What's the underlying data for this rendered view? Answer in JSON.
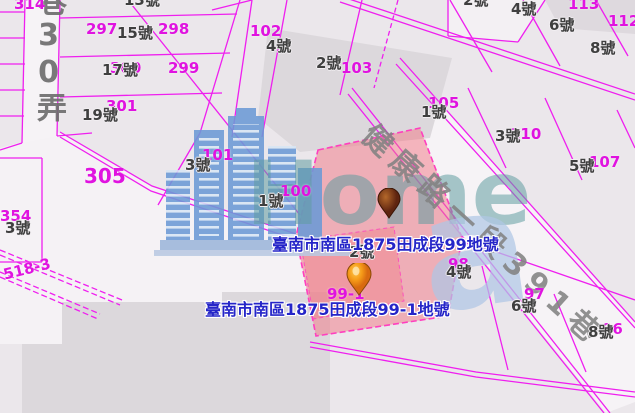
{
  "map": {
    "street_names": {
      "diagonal": "健康路一段391巷",
      "vertical": "巷30弄"
    },
    "address_labels": [
      {
        "id": "addr-99",
        "text": "臺南市南區1875田成段99地號"
      },
      {
        "id": "addr-99-1",
        "text": "臺南市南區1875田成段99-1地號"
      }
    ],
    "watermark": {
      "brand": "Home",
      "glyph": "a"
    },
    "markers": [
      {
        "id": "marker-99",
        "color": "#6b2c10"
      },
      {
        "id": "marker-99-1",
        "color": "#f59a18"
      }
    ],
    "parcel_numbers": [
      {
        "t": "314",
        "x": 14,
        "y": -3
      },
      {
        "t": "297",
        "x": 86,
        "y": 22
      },
      {
        "t": "298",
        "x": 158,
        "y": 22
      },
      {
        "t": "300",
        "x": 110,
        "y": 61
      },
      {
        "t": "299",
        "x": 168,
        "y": 61
      },
      {
        "t": "301",
        "x": 106,
        "y": 99
      },
      {
        "t": "305",
        "x": 84,
        "y": 166,
        "fs": 20
      },
      {
        "t": "102",
        "x": 250,
        "y": 24
      },
      {
        "t": "103",
        "x": 341,
        "y": 61
      },
      {
        "t": "113",
        "x": 568,
        "y": -3
      },
      {
        "t": "112",
        "x": 608,
        "y": 14
      },
      {
        "t": "105",
        "x": 428,
        "y": 96
      },
      {
        "t": "110",
        "x": 510,
        "y": 127
      },
      {
        "t": "107",
        "x": 589,
        "y": 155
      },
      {
        "t": "101",
        "x": 202,
        "y": 148
      },
      {
        "t": "100",
        "x": 280,
        "y": 184
      },
      {
        "t": "99-1",
        "x": 327,
        "y": 287
      },
      {
        "t": "98",
        "x": 448,
        "y": 257
      },
      {
        "t": "97",
        "x": 524,
        "y": 287
      },
      {
        "t": "96",
        "x": 602,
        "y": 322
      },
      {
        "t": "354",
        "x": 0,
        "y": 209
      },
      {
        "t": "518-3",
        "x": 2,
        "y": 268,
        "rot": -14
      }
    ],
    "house_numbers": [
      {
        "t": "13號",
        "x": 124,
        "y": -7
      },
      {
        "t": "15號",
        "x": 117,
        "y": 26
      },
      {
        "t": "17號",
        "x": 102,
        "y": 63
      },
      {
        "t": "19號",
        "x": 82,
        "y": 108
      },
      {
        "t": "4號",
        "x": 266,
        "y": 39
      },
      {
        "t": "2號",
        "x": 316,
        "y": 56
      },
      {
        "t": "2號",
        "x": 463,
        "y": -7
      },
      {
        "t": "4號",
        "x": 511,
        "y": 2
      },
      {
        "t": "6號",
        "x": 549,
        "y": 18
      },
      {
        "t": "8號",
        "x": 590,
        "y": 41
      },
      {
        "t": "1號",
        "x": 421,
        "y": 105
      },
      {
        "t": "3號",
        "x": 495,
        "y": 129
      },
      {
        "t": "5號",
        "x": 569,
        "y": 159
      },
      {
        "t": "3號",
        "x": 185,
        "y": 158
      },
      {
        "t": "1號",
        "x": 258,
        "y": 194
      },
      {
        "t": "2號",
        "x": 349,
        "y": 245
      },
      {
        "t": "4號",
        "x": 446,
        "y": 265
      },
      {
        "t": "6號",
        "x": 511,
        "y": 299
      },
      {
        "t": "8號",
        "x": 588,
        "y": 325
      },
      {
        "t": "3號",
        "x": 5,
        "y": 221
      }
    ],
    "colors": {
      "parcel_line": "#ef1fef",
      "label_magenta": "#e013e0",
      "house_number": "#3f3f3f",
      "highlight_fill": "#f17684",
      "address_text": "#2525c8",
      "street_text": "#8a8a8a",
      "watermark_blue": "#6c9ad6",
      "watermark_teal": "#5f9ca0"
    }
  }
}
